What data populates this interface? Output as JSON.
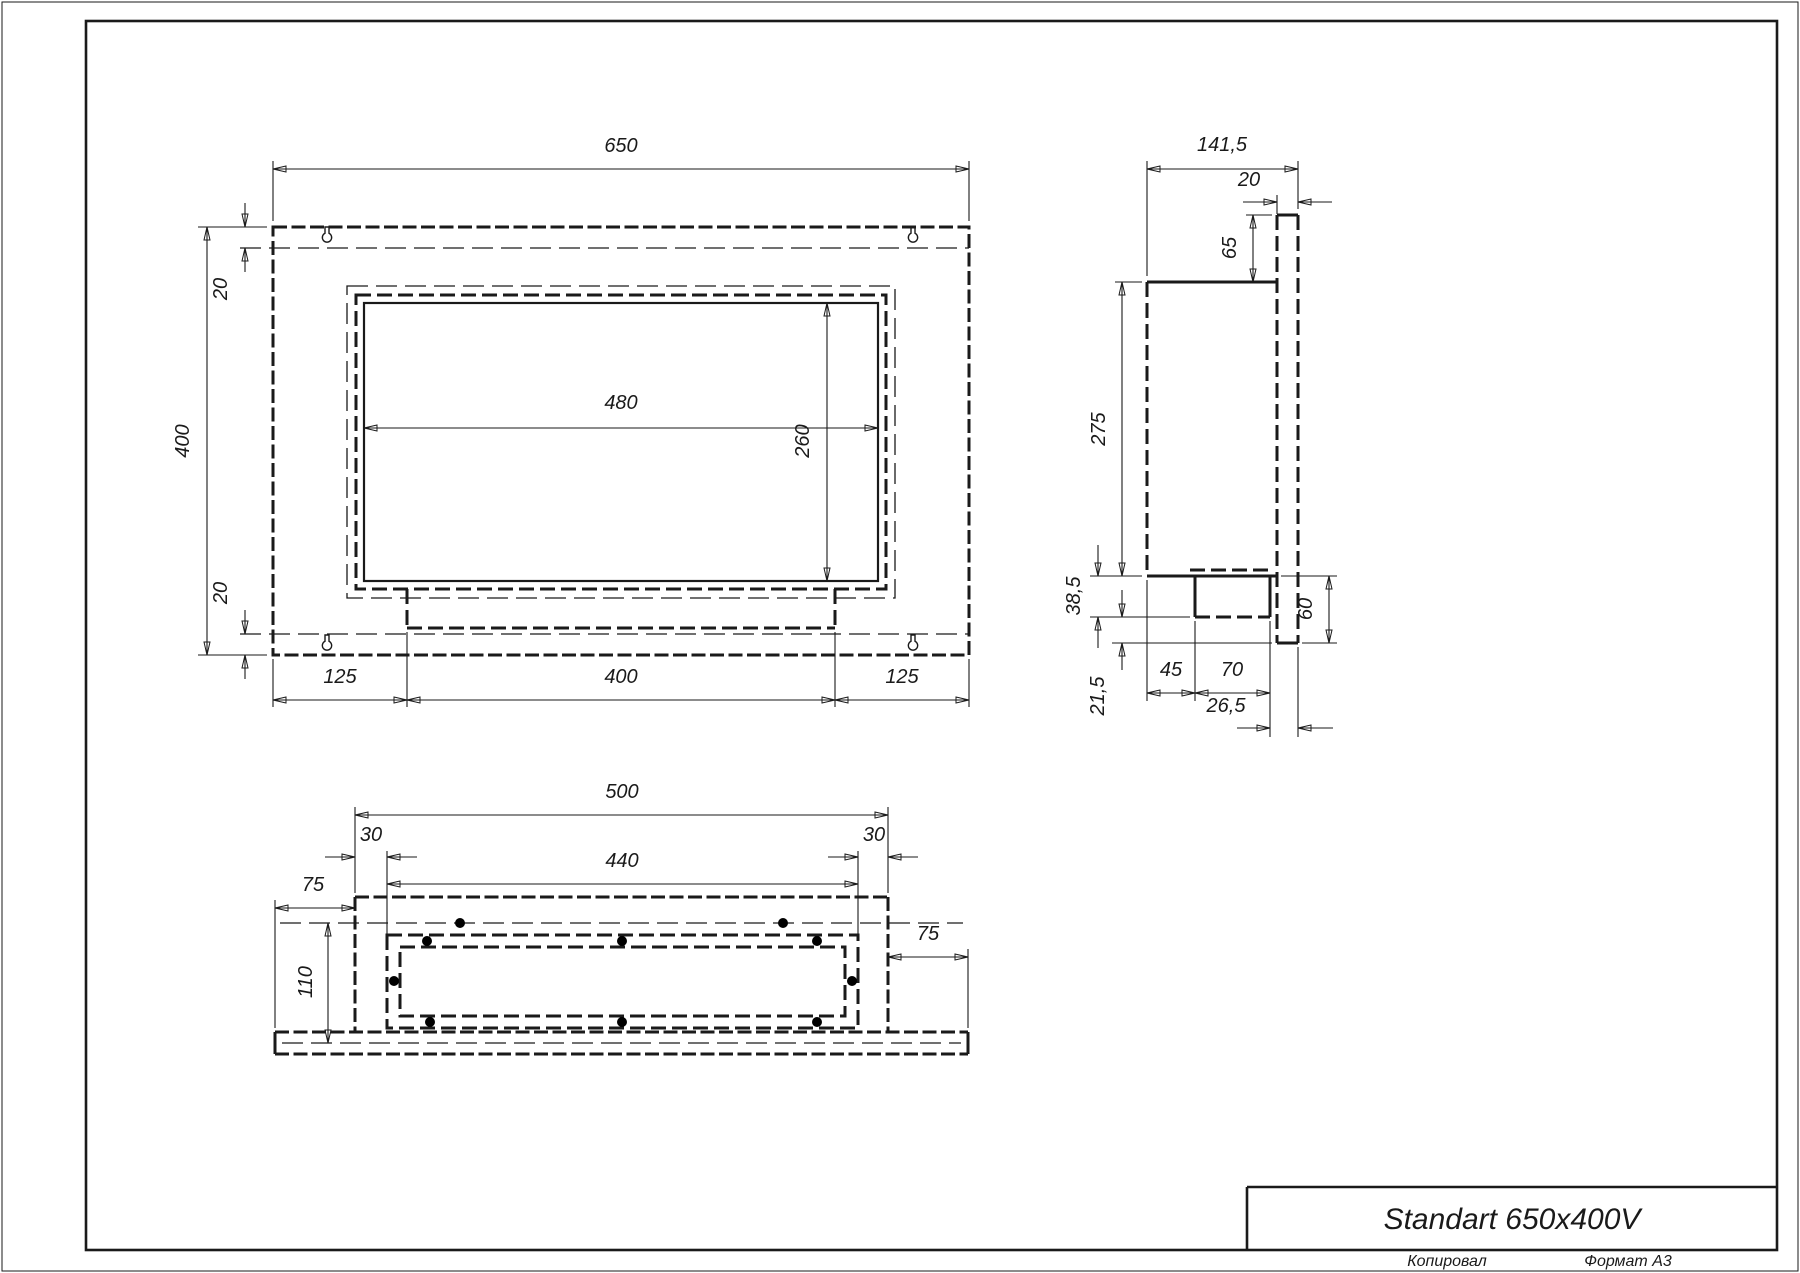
{
  "title_block": {
    "title": "Standart 650x400V"
  },
  "footer": {
    "copied_label": "Копировал",
    "format_label": "Формат А3"
  },
  "colors": {
    "line": "#1a1a1a",
    "background": "#ffffff"
  },
  "views": {
    "front": {
      "name": "front-view",
      "dims": {
        "width": "650",
        "height": "400",
        "flange_top": "20",
        "flange_bottom": "20",
        "opening_width": "480",
        "opening_height": "260",
        "bottom_left": "125",
        "bottom_center": "400",
        "bottom_right": "125"
      }
    },
    "side": {
      "name": "side-view",
      "dims": {
        "depth": "141,5",
        "plate_thickness": "20",
        "top_offset": "65",
        "body_height": "275",
        "tray_drop": "38,5",
        "bottom_gap": "21,5",
        "tray_front": "45",
        "tray_width": "70",
        "tray_back": "26,5",
        "plate_below": "60"
      }
    },
    "bottom": {
      "name": "bottom-view",
      "dims": {
        "body_width": "500",
        "offset_left": "30",
        "inner_width": "440",
        "offset_right": "30",
        "flange_left": "75",
        "inner_depth": "110",
        "flange_right": "75"
      }
    }
  }
}
